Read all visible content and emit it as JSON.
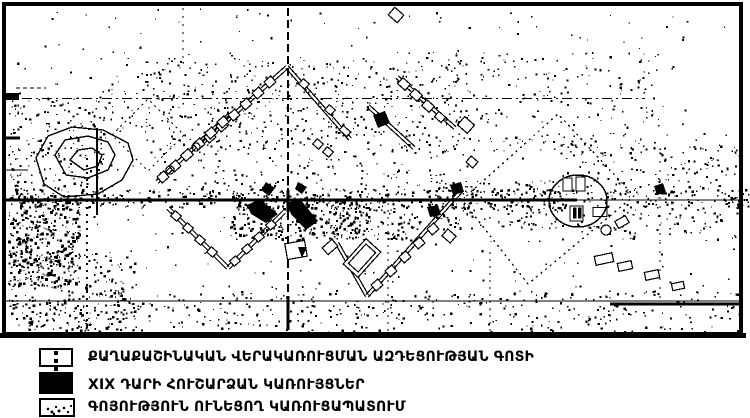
{
  "colors": {
    "ink": "#000000",
    "paper": "#ffffff"
  },
  "legend": {
    "items": [
      {
        "label": "ՔԱՂԱՔԱՇԻՆԱԿԱՆ ՎԵՐԱԿԱՌՈՒՑՄԱՆ ԱԶԴԵՑՈՒԹՅԱՆ ԳՈՏԻ",
        "swatch": "dashed-line-box"
      },
      {
        "label": "XIX ԴԱՐԻ ՀՈՒՇԱՐՁԱՆ ԿԱՌՈՒՅՑՆԵՐ",
        "swatch": "solid-black-box"
      },
      {
        "label": "ԳՈՅՈՒԹՅՈՒՆ ՈՒՆԵՑՈՂ ԿԱՌՈՒՑԱՊԱՏՈՒՄ",
        "swatch": "speckled-box"
      }
    ]
  },
  "map": {
    "width": 750,
    "height": 338,
    "ink": "#000000",
    "noise_seed": 1337,
    "noise_regions": [
      [
        8,
        8,
        726,
        320,
        380,
        2.2
      ],
      [
        100,
        52,
        560,
        100,
        420,
        2.2
      ],
      [
        8,
        96,
        96,
        110,
        220,
        2.4
      ],
      [
        8,
        188,
        740,
        20,
        420,
        2.6
      ],
      [
        230,
        192,
        130,
        48,
        260,
        2.8
      ],
      [
        8,
        195,
        72,
        90,
        380,
        3
      ],
      [
        8,
        250,
        130,
        80,
        240,
        2.6
      ],
      [
        330,
        198,
        90,
        42,
        150,
        2.4
      ],
      [
        560,
        140,
        180,
        100,
        260,
        2.4
      ],
      [
        8,
        290,
        732,
        44,
        420,
        2.4
      ],
      [
        150,
        60,
        320,
        130,
        380,
        2.2
      ],
      [
        430,
        180,
        130,
        50,
        160,
        2.4
      ]
    ],
    "h_lines": [
      [
        2,
        98.5,
        645,
        98.5,
        1,
        "10 4 2 4"
      ],
      [
        2,
        200,
        577,
        200,
        3,
        ""
      ],
      [
        577,
        200,
        742,
        200,
        1.2,
        ""
      ],
      [
        2,
        301,
        742,
        301,
        1,
        ""
      ],
      [
        610,
        304,
        742,
        304,
        3,
        ""
      ],
      [
        6,
        138,
        20,
        138,
        3,
        ""
      ],
      [
        6,
        170,
        28,
        170,
        1.2,
        ""
      ],
      [
        16,
        88,
        46,
        88,
        1,
        "4 3"
      ]
    ],
    "v_lines": [
      [
        87,
        158,
        333,
        2,
        "2 5"
      ],
      [
        183,
        8,
        60,
        1.2,
        "2 6"
      ],
      [
        288,
        8,
        333,
        2,
        "8 4"
      ],
      [
        288,
        190,
        212,
        3,
        ""
      ],
      [
        288,
        296,
        330,
        3,
        ""
      ],
      [
        388,
        196,
        333,
        1.2,
        "2 5"
      ],
      [
        490,
        252,
        333,
        1.2,
        "2 5"
      ],
      [
        660,
        152,
        300,
        1.2,
        "2 7"
      ],
      [
        97,
        128,
        215,
        1.8,
        ""
      ]
    ],
    "diamonds": [
      {
        "pts": "462,200 558,114 634,196 528,284",
        "dash": "2 4"
      },
      {
        "pts": "112,135 148,99 184,135 148,171",
        "dash": "2 4"
      }
    ],
    "streets": [
      [
        [
          202,
          143
        ],
        [
          287,
          67
        ],
        [
          350,
          139
        ]
      ],
      [
        [
          157,
          182
        ],
        [
          230,
          114
        ]
      ],
      [
        [
          168,
          208
        ],
        [
          228,
          268
        ],
        [
          284,
          212
        ]
      ],
      [
        [
          337,
          243
        ],
        [
          367,
          296
        ],
        [
          462,
          190
        ]
      ],
      [
        [
          397,
          77
        ],
        [
          455,
          128
        ]
      ],
      [
        [
          368,
          106
        ],
        [
          414,
          148
        ]
      ]
    ],
    "buildings": [
      [
        210,
        137,
        9,
        8,
        -41
      ],
      [
        222,
        126,
        9,
        8,
        -41
      ],
      [
        234,
        115,
        9,
        8,
        -41
      ],
      [
        246,
        104,
        9,
        8,
        -41
      ],
      [
        258,
        93,
        9,
        8,
        -41
      ],
      [
        270,
        82,
        9,
        8,
        -41
      ],
      [
        304,
        84,
        8,
        7,
        41
      ],
      [
        330,
        110,
        8,
        7,
        41
      ],
      [
        345,
        131,
        10,
        6,
        41
      ],
      [
        163,
        177,
        9,
        8,
        -41
      ],
      [
        175,
        166,
        9,
        8,
        -41
      ],
      [
        187,
        155,
        10,
        8,
        -41
      ],
      [
        199,
        144,
        9,
        8,
        -41
      ],
      [
        211,
        133,
        9,
        8,
        -41
      ],
      [
        223,
        122,
        9,
        8,
        -41
      ],
      [
        176,
        216,
        8,
        7,
        41
      ],
      [
        188,
        228,
        8,
        7,
        41
      ],
      [
        200,
        240,
        8,
        7,
        41
      ],
      [
        212,
        252,
        8,
        7,
        41
      ],
      [
        235,
        261,
        8,
        7,
        -41
      ],
      [
        247,
        249,
        8,
        7,
        -41
      ],
      [
        259,
        237,
        8,
        7,
        -41
      ],
      [
        271,
        225,
        8,
        7,
        -41
      ],
      [
        377,
        285,
        9,
        8,
        -41
      ],
      [
        391,
        271,
        9,
        8,
        -41
      ],
      [
        405,
        257,
        9,
        8,
        -41
      ],
      [
        419,
        243,
        9,
        8,
        -41
      ],
      [
        433,
        229,
        9,
        8,
        -41
      ],
      [
        404,
        84,
        10,
        8,
        41
      ],
      [
        416,
        95,
        10,
        8,
        41
      ],
      [
        428,
        106,
        10,
        8,
        41
      ],
      [
        440,
        117,
        9,
        7,
        41
      ],
      [
        466,
        125,
        13,
        11,
        41
      ],
      [
        396,
        15,
        12,
        10,
        41
      ],
      [
        318,
        144,
        8,
        7,
        41
      ],
      [
        328,
        152,
        8,
        7,
        41
      ],
      [
        449,
        236,
        11,
        9,
        41
      ],
      [
        330,
        247,
        13,
        9,
        -41
      ],
      [
        362,
        258,
        34,
        20,
        -48
      ],
      [
        362,
        258,
        26,
        13,
        -48
      ],
      [
        472,
        162,
        9,
        8,
        41
      ],
      [
        604,
        259,
        18,
        9,
        -12
      ],
      [
        625,
        266,
        14,
        8,
        -12
      ],
      [
        652,
        275,
        14,
        8,
        -12
      ],
      [
        678,
        286,
        12,
        7,
        -12
      ],
      [
        600,
        212,
        14,
        9,
        0
      ],
      [
        622,
        222,
        12,
        8,
        -30
      ],
      [
        296,
        250,
        20,
        16,
        -10
      ]
    ],
    "circles": [
      [
        170,
        170,
        4
      ],
      [
        196,
        147,
        4
      ],
      [
        606,
        230,
        5
      ]
    ],
    "monuments": [
      "247,205 260,199 278,214 266,223 251,214",
      "287,203 300,199 318,221 306,230 291,214",
      "266,182 275,188 269,196 261,190",
      "298,182 307,187 302,194 295,189",
      "373,115 385,111 390,123 378,128",
      "298,247 307,247 302,258",
      "6,93 19,93 19,100 6,100",
      "450,185 461,182 464,192 453,195",
      "427,207 438,205 441,215 430,217",
      "654,186 663,183 666,192 657,195"
    ],
    "mound_rings": [
      "36,158 48,136 72,127 103,130 128,143 133,160 122,180 98,194 64,197 44,184",
      "55,155 65,140 88,136 108,142 115,155 108,170 88,178 66,175",
      "70,160 78,150 92,148 102,155 98,166 84,170"
    ],
    "circle_feature": {
      "cx": 578,
      "cy": 201,
      "rx": 29,
      "ry": 26,
      "rects": [
        [
          563,
          178,
          9,
          13,
          0
        ],
        [
          576,
          177,
          9,
          14,
          0
        ],
        [
          570,
          206,
          13,
          15,
          0
        ],
        [
          573.5,
          208,
          2.5,
          10,
          1
        ],
        [
          578.5,
          208,
          2.5,
          10,
          1
        ]
      ]
    }
  }
}
